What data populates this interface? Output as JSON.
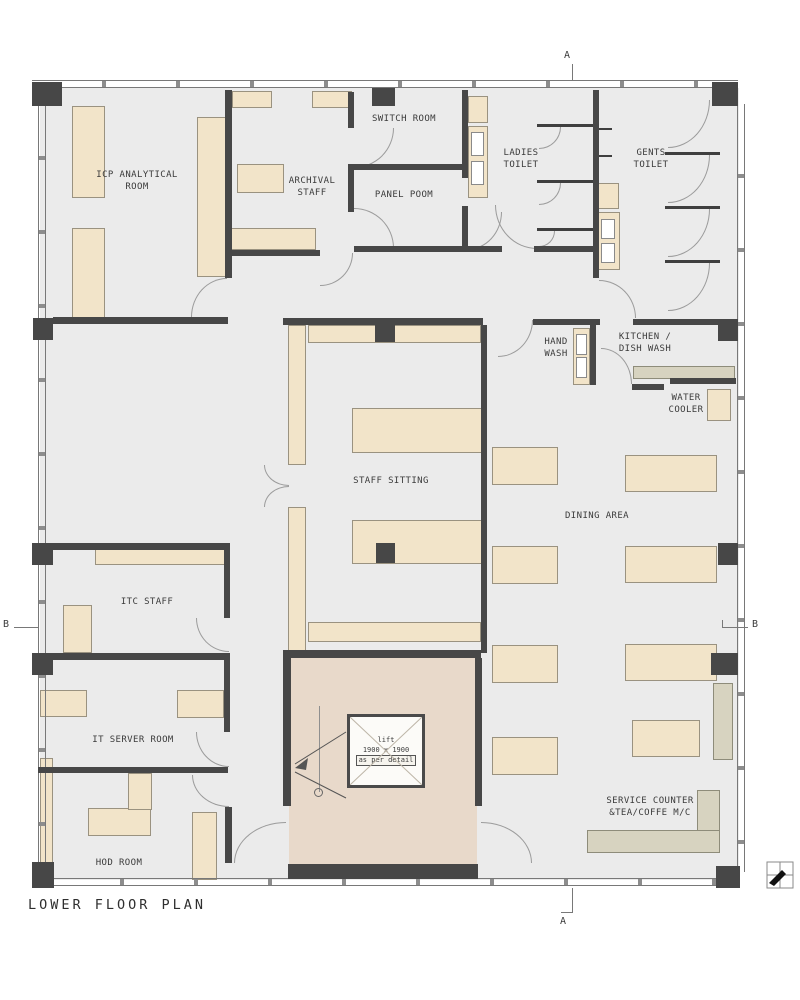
{
  "plan": {
    "title": "LOWER FLOOR PLAN",
    "rooms": {
      "icp": "ICP ANALYTICAL\nROOM",
      "archival": "ARCHIVAL\nSTAFF",
      "switch_room": "SWITCH ROOM",
      "panel_room": "PANEL POOM",
      "ladies_toilet": "LADIES\nTOILET",
      "gents_toilet": "GENTS\nTOILET",
      "hand_wash": "HAND\nWASH",
      "kitchen": "KITCHEN /\nDISH WASH",
      "water_cooler": "WATER\nCOOLER",
      "staff_sitting": "STAFF SITTING",
      "dining": "DINING AREA",
      "itc_staff": "ITC STAFF",
      "it_server": "IT SERVER ROOM",
      "hod": "HOD ROOM",
      "service_counter": "SERVICE COUNTER\n&TEA/COFFE M/C"
    },
    "lift": {
      "name": "lift",
      "size": "1900 x 1900",
      "note": "as per detail"
    },
    "sections": {
      "a": "A",
      "b": "B"
    },
    "colors": {
      "wall": "#474747",
      "floor": "#ebebeb",
      "furniture": "#f2e4c9",
      "counter": "#d7d3c0",
      "lobby": "#e8d9ca"
    }
  }
}
